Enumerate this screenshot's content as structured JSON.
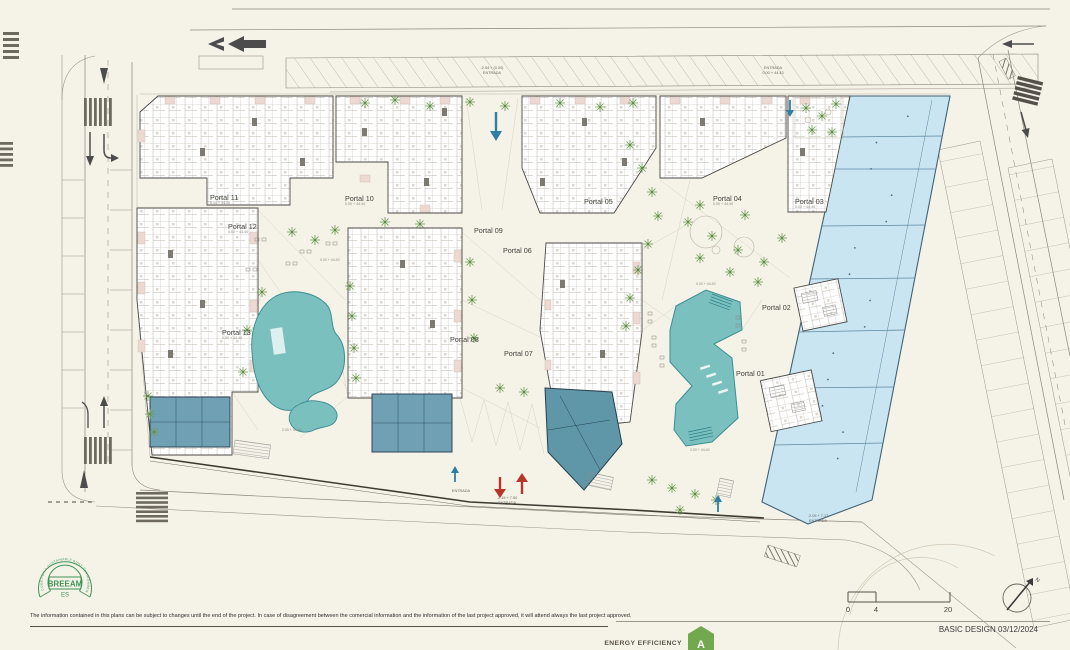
{
  "plan": {
    "portals": [
      {
        "label": "Portal 01"
      },
      {
        "label": "Portal 02"
      },
      {
        "label": "Portal 03",
        "elev": "0.00 + 44.40"
      },
      {
        "label": "Portal 04",
        "elev": "0.00 + 44.40"
      },
      {
        "label": "Portal 05"
      },
      {
        "label": "Portal 06"
      },
      {
        "label": "Portal 07"
      },
      {
        "label": "Portal 08"
      },
      {
        "label": "Portal 09"
      },
      {
        "label": "Portal 10",
        "elev": "0.00 + 44.40"
      },
      {
        "label": "Portal 11",
        "elev": "0.00 + 44.40"
      },
      {
        "label": "Portal 12",
        "elev": "0.00 + 44.40"
      },
      {
        "label": "Portal 13",
        "elev": "0.00 + 44.40"
      }
    ]
  },
  "entrances": [
    {
      "lines": [
        "-2.54 + (0.00)",
        "ENTRADA"
      ]
    },
    {
      "lines": [
        "ENTRADA",
        "0.00 + 44.43"
      ]
    },
    {
      "lines": [
        "-2.15 + 7.50",
        "ENTRADA"
      ]
    },
    {
      "lines": [
        "-2.05 + 7.17",
        "ENTRADA"
      ]
    },
    {
      "lines": [
        "ENTRADA"
      ]
    }
  ],
  "spots": [
    "0.00 + 44.40",
    "0.00 + 44.40",
    "0.00 + 44.40",
    "0.00 + 44.40"
  ],
  "breeam": {
    "ring_text": "CODE FOR A SUSTAINABLE BUILT ENVIRONMENT",
    "name": "BREEAM",
    "region": "ES"
  },
  "scale_bar": {
    "labels": [
      "0",
      "4",
      "20"
    ]
  },
  "compass": {
    "north": "N"
  },
  "footer": {
    "disclaimer": "The information contained in this plans can be subject to changes until the end of the project. In case of disagreement between the comercial information and the information of the last project approved, it will attend always the last project approved.",
    "basic_design": "BASIC DESIGN 03/12/2024",
    "energy_label": "ENERGY EFFICIENCY",
    "energy_rating": "A"
  },
  "colors": {
    "paper": "#f5f2e8",
    "pool_teal": "#79c0bf",
    "commercial_blue": "#c9e5f2",
    "slate_block": "#6fa0b4",
    "breeam_green": "#3f9457",
    "energy_green": "#72a84e",
    "entry_red": "#b5372b",
    "entry_blue": "#2d7fa5"
  }
}
